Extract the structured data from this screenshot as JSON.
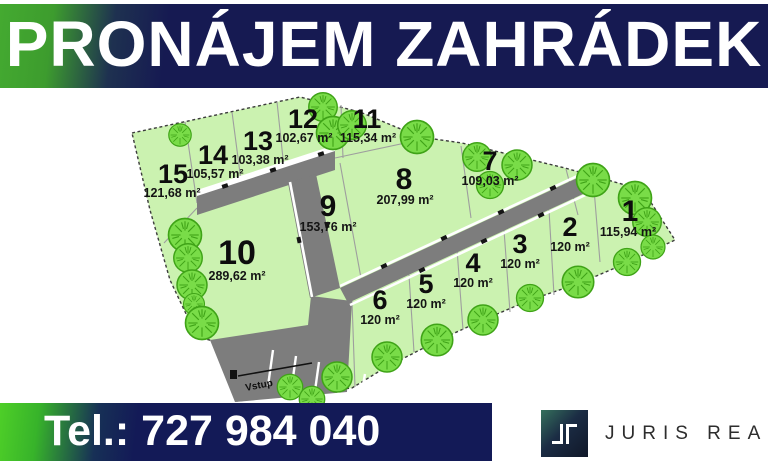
{
  "header": {
    "title": "PRONÁJEM ZAHRÁDEK"
  },
  "map": {
    "entrance_label": "Vstup",
    "plots": [
      {
        "number": "1",
        "area": "115,94 m²"
      },
      {
        "number": "2",
        "area": "120 m²"
      },
      {
        "number": "3",
        "area": "120 m²"
      },
      {
        "number": "4",
        "area": "120 m²"
      },
      {
        "number": "5",
        "area": "120 m²"
      },
      {
        "number": "6",
        "area": "120 m²"
      },
      {
        "number": "7",
        "area": "109,03 m²"
      },
      {
        "number": "8",
        "area": "207,99 m²"
      },
      {
        "number": "9",
        "area": "153,76 m²"
      },
      {
        "number": "10",
        "area": "289,62 m²"
      },
      {
        "number": "11",
        "area": "115,34 m²"
      },
      {
        "number": "12",
        "area": "102,67 m²"
      },
      {
        "number": "13",
        "area": "103,38 m²"
      },
      {
        "number": "14",
        "area": "105,57 m²"
      },
      {
        "number": "15",
        "area": "121,68 m²"
      }
    ]
  },
  "footer": {
    "phone": "Tel.: 727 984 040",
    "brand": "JURIS REAL"
  },
  "colors": {
    "banner_navy": "#161a52",
    "banner_green": "#3fa32e",
    "footer_green": "#3ec522",
    "plot_green": "#cbf2b0",
    "tree_green": "#79dc48",
    "road_gray": "#7d7d7d",
    "logo_navy": "#101728",
    "logo_teal": "#35705c",
    "brand_text": "#2d2d2d"
  }
}
